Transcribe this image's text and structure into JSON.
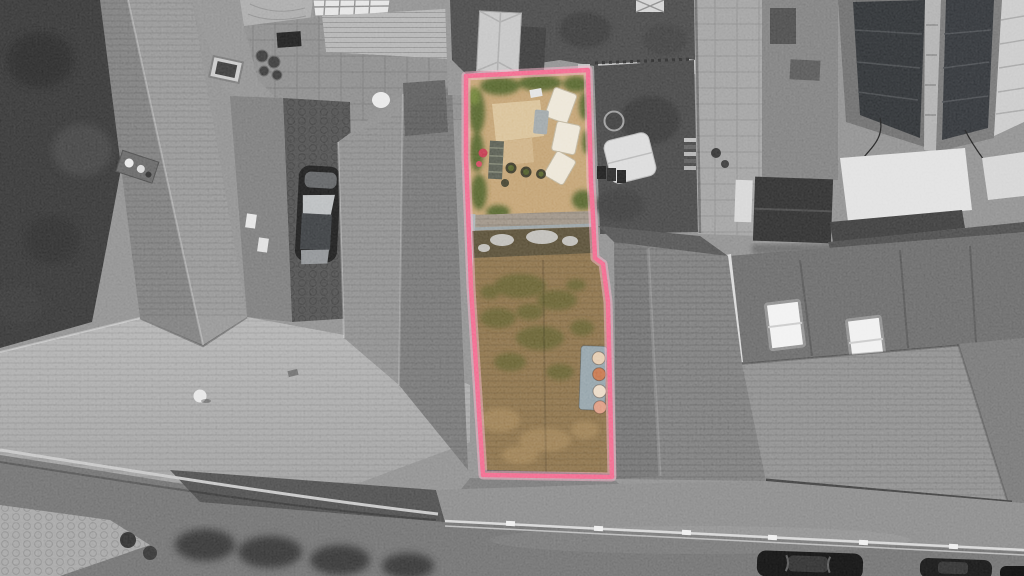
{
  "scene": {
    "type": "aerial-drone-photograph",
    "subject": "Terraced stone buildings viewed from above; a narrow plot with a walled garden and a long moss-covered roof is highlighted, surrounded by greyscale rooftops, a parked car, solar panels, gardens and a road with railings and parked cars",
    "treatment": "black-and-white photograph with colour retained only inside the pink property boundary"
  },
  "boundary": {
    "label": "property-boundary",
    "color": "#F2688C",
    "halo": "#F9B4C9"
  },
  "colors": {
    "garden_patio": "#C1A071",
    "garden_slabs": "#D9C298",
    "garden_green": "#55632E",
    "garden_green_bright": "#6E8039",
    "lounger_cream": "#ECE5D6",
    "table_grey": "#9EA5A7",
    "steps_grey": "#575B50",
    "red_item": "#C23B4E",
    "glaze_brown": "#574D36",
    "moss_roof": "#8A7049",
    "moss_green": "#5F5D2D",
    "roof_tan": "#A98A5C",
    "slate_strip": "#9C9184",
    "chimney_base": "#92A1A8",
    "pot_1": "#E3CAAE",
    "pot_2": "#C5744B",
    "pot_3": "#EAD9C5",
    "pot_4": "#DD9A81"
  }
}
